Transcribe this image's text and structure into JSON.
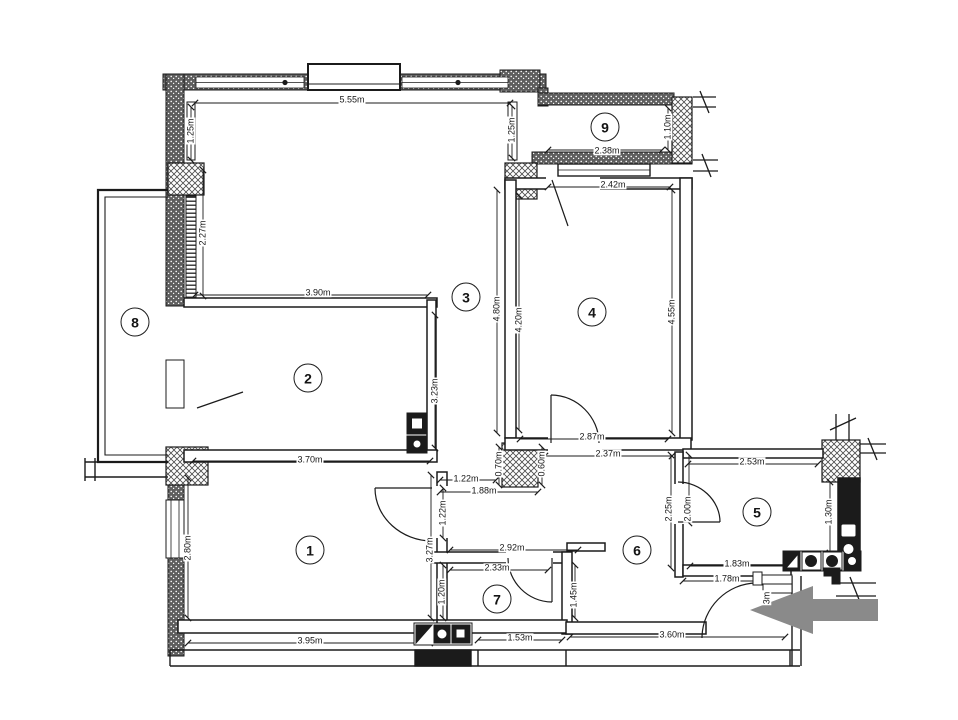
{
  "plan": {
    "title": "apartment-floor-plan",
    "colors": {
      "line": "#1b1b1b",
      "arrow": "#8a8a8a",
      "background": "#ffffff"
    },
    "rooms": [
      {
        "label": "1"
      },
      {
        "label": "2"
      },
      {
        "label": "3"
      },
      {
        "label": "4"
      },
      {
        "label": "5"
      },
      {
        "label": "6"
      },
      {
        "label": "7"
      },
      {
        "label": "8"
      },
      {
        "label": "9"
      }
    ],
    "dims": [
      {
        "text": "5.55m"
      },
      {
        "text": "1.25m"
      },
      {
        "text": "1.25m"
      },
      {
        "text": "2.27m"
      },
      {
        "text": "3.90m"
      },
      {
        "text": "2.38m"
      },
      {
        "text": "1.10m"
      },
      {
        "text": "2.42m"
      },
      {
        "text": "4.80m"
      },
      {
        "text": "4.20m"
      },
      {
        "text": "4.55m"
      },
      {
        "text": "2.87m"
      },
      {
        "text": "2.37m"
      },
      {
        "text": "3.23m"
      },
      {
        "text": "3.70m"
      },
      {
        "text": "1.22m"
      },
      {
        "text": "1.88m"
      },
      {
        "text": "0.70m"
      },
      {
        "text": "0.60m"
      },
      {
        "text": "2.80m"
      },
      {
        "text": "1.22m"
      },
      {
        "text": "3.27m"
      },
      {
        "text": "1.20m"
      },
      {
        "text": "2.92m"
      },
      {
        "text": "2.33m"
      },
      {
        "text": "1.45m"
      },
      {
        "text": "3.95m"
      },
      {
        "text": "1.53m"
      },
      {
        "text": "3.60m"
      },
      {
        "text": "2.25m"
      },
      {
        "text": "2.00m"
      },
      {
        "text": "2.53m"
      },
      {
        "text": "1.30m"
      },
      {
        "text": "1.83m"
      },
      {
        "text": "1.78m"
      },
      {
        "text": "3m"
      }
    ]
  }
}
